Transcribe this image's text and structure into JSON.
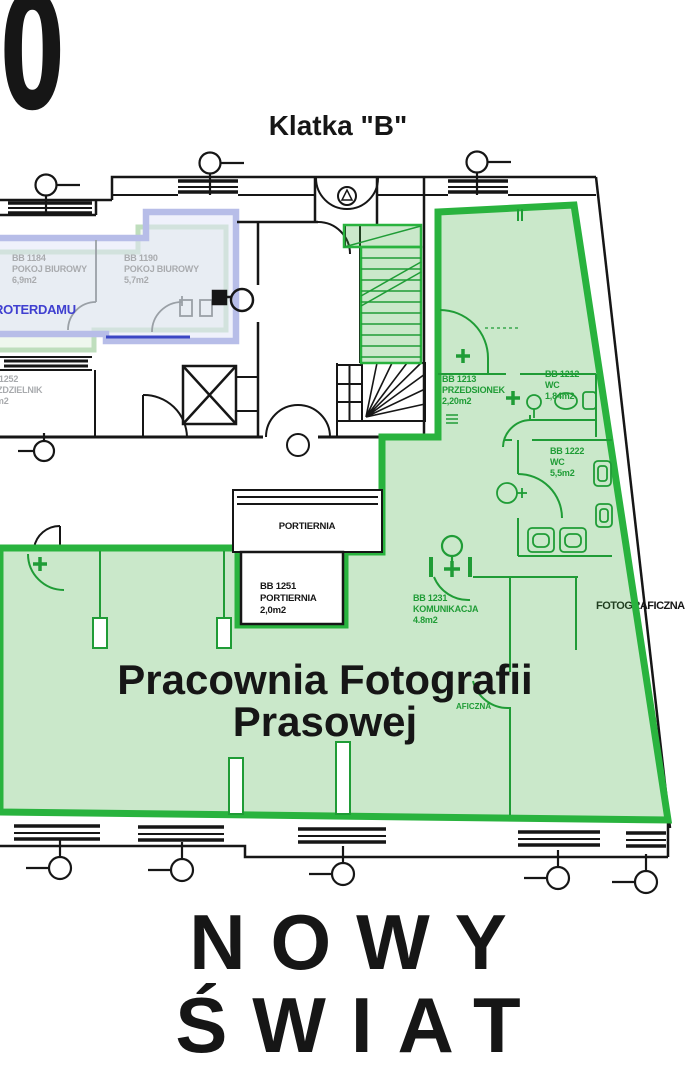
{
  "figure_number": "0",
  "labels": {
    "klatka_b": "Klatka \"B\"",
    "portiernia": "PORTIERNIA",
    "roterdamu": "ROTERDAMU",
    "fotograficzna": "FOTOGRAFICZNA",
    "aficzna": "AFICZNA"
  },
  "title": {
    "line1": "Pracownia Fotografii",
    "line2": "Prasowej"
  },
  "street": {
    "line1": "NOWY",
    "line2": "ŚWIAT"
  },
  "rooms": [
    {
      "id": "BB 1184",
      "name": "POKOJ BIUROWY",
      "area": "6,9m2"
    },
    {
      "id": "BB 1190",
      "name": "POKOJ BIUROWY",
      "area": "5,7m2"
    },
    {
      "id": "BB 1252",
      "name": "ROZDZIELNIK",
      "area": "1,5m2"
    },
    {
      "id": "BB 1213",
      "name": "PRZEDSIONEK",
      "area": "2,20m2"
    },
    {
      "id": "BB 1212",
      "name": "WC",
      "area": "1,84m2"
    },
    {
      "id": "BB 1222",
      "name": "WC",
      "area": "5,5m2"
    },
    {
      "id": "BB 1231",
      "name": "KOMUNIKACJA",
      "area": "4.8m2"
    },
    {
      "id": "BB 1251",
      "name": "PORTIERNIA",
      "area": "2,0m2"
    }
  ],
  "colors": {
    "green_border": "#29b33e",
    "green_fill": "rgba(60,170,60,0.27)",
    "green_line": "#1f9c36",
    "green_text": "#1f9c36",
    "lavender": "#b7bde8",
    "lavender_fill": "rgba(225,229,248,0.55)",
    "pale_green": "#b5d9b2",
    "pale_green_fill": "rgba(202,229,199,0.35)",
    "navy": "#3b47c4",
    "grey_text": "#a9abae",
    "grey_wall": "#9aa0a6",
    "black": "#161616",
    "blue_text": "#4040d0"
  }
}
